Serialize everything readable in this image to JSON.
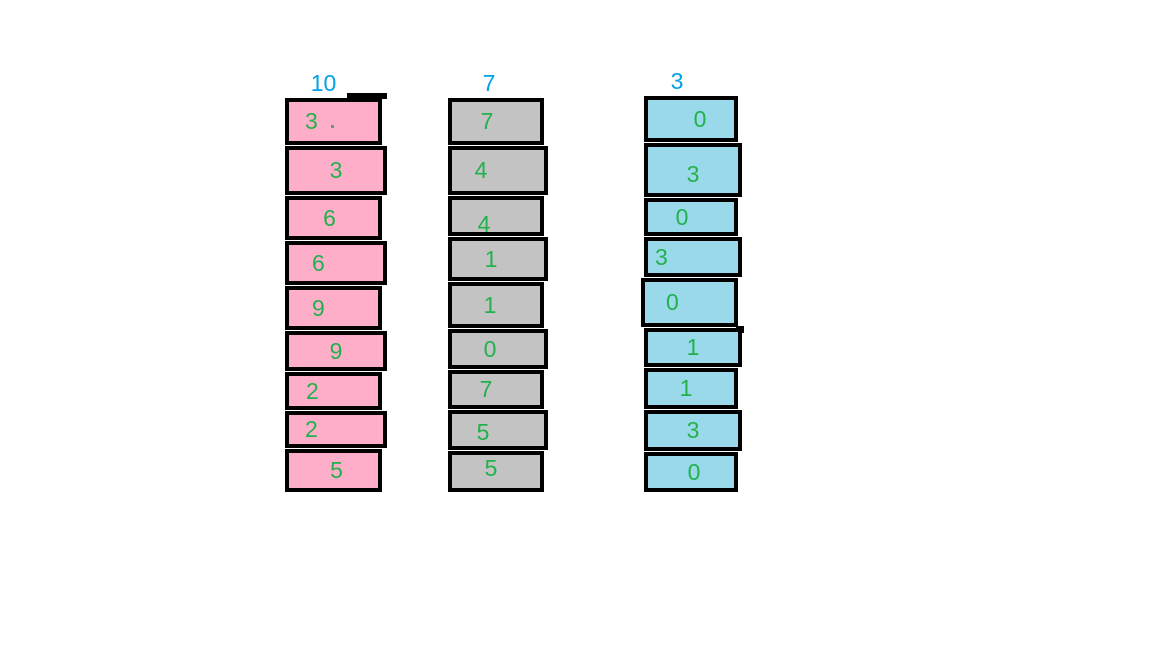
{
  "colors": {
    "background": "#FFFFFF",
    "outline_black": "#000000",
    "digit_green": "#22B14C",
    "label_blue": "#00A2E8",
    "column_1_fill_pink": "#FFAEC9",
    "column_2_fill_gray": "#C3C3C3",
    "column_3_fill_turquoise": "#99D9EA"
  },
  "columns": [
    {
      "label": "10",
      "fill": "#FFAEC9",
      "cells": [
        "3",
        "3",
        "6",
        "6",
        "9",
        "9",
        "2",
        "2",
        "5"
      ]
    },
    {
      "label": "7",
      "fill": "#C3C3C3",
      "cells": [
        "7",
        "4",
        "4",
        "1",
        "1",
        "0",
        "7",
        "5",
        "5"
      ]
    },
    {
      "label": "3",
      "fill": "#99D9EA",
      "cells": [
        "0",
        "3",
        "0",
        "3",
        "0",
        "1",
        "1",
        "3",
        "0"
      ]
    }
  ]
}
